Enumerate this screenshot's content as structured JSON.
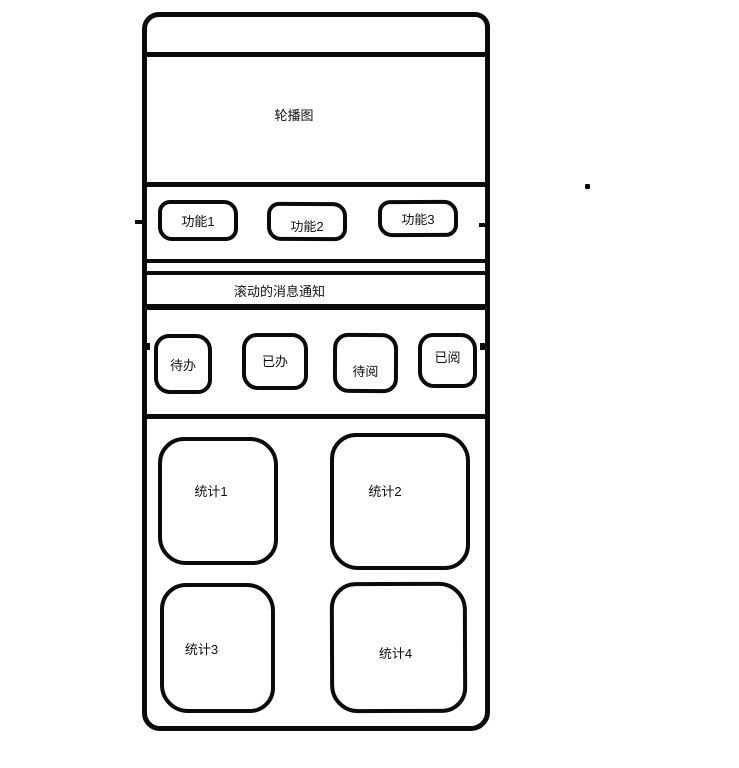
{
  "diagram": {
    "ink_color": "#0b0b0b",
    "bg_color": "#ffffff",
    "phone": {
      "carousel": {
        "label": "轮播图"
      },
      "function_buttons": [
        {
          "label": "功能1"
        },
        {
          "label": "功能2"
        },
        {
          "label": "功能3"
        }
      ],
      "notice": {
        "label": "滚动的消息通知"
      },
      "status_buttons": [
        {
          "label": "待办"
        },
        {
          "label": "已办"
        },
        {
          "label": "待阅"
        },
        {
          "label": "已阅"
        }
      ],
      "stat_cards": [
        {
          "label": "统计1"
        },
        {
          "label": "统计2"
        },
        {
          "label": "统计3"
        },
        {
          "label": "统计4"
        }
      ]
    }
  }
}
